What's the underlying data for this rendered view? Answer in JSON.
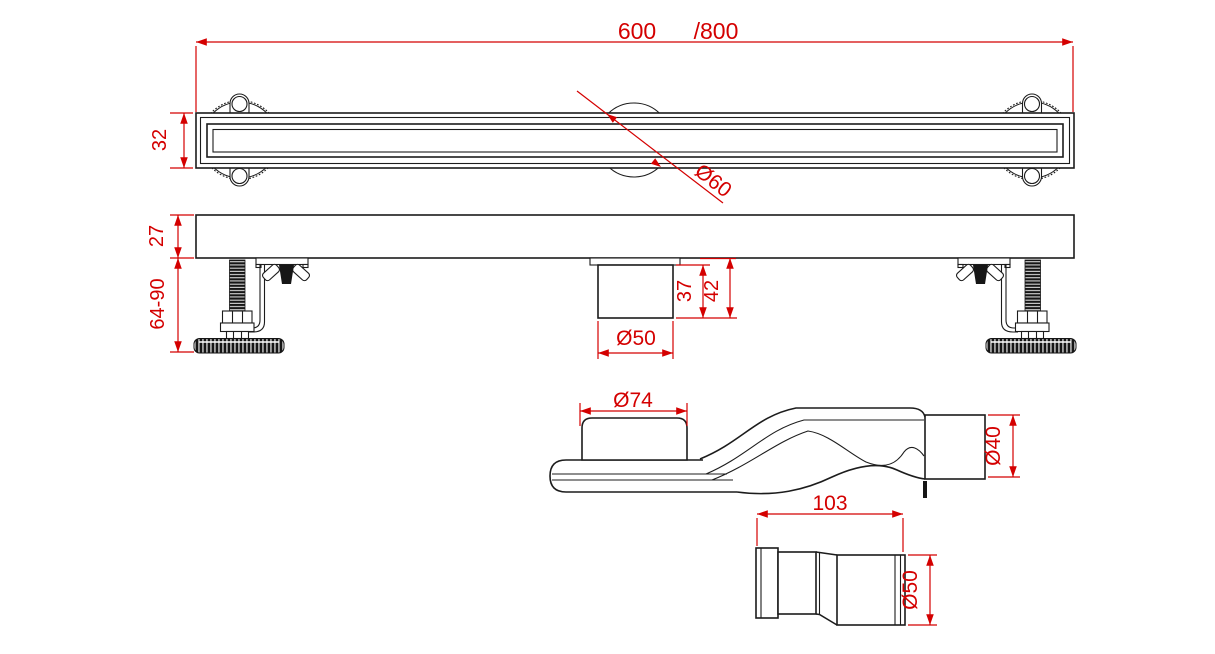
{
  "colors": {
    "dimension": "#d40000",
    "line": "#1c1c1c",
    "background": "#ffffff"
  },
  "top_view": {
    "length": "600",
    "length_alt": "/800",
    "height": "32",
    "center_flange_dia": "Ø60"
  },
  "side_view": {
    "body_height": "27",
    "feet_adjust_range": "64-90",
    "spigot_height": "37",
    "spigot_total_height": "42",
    "spigot_dia": "Ø50"
  },
  "trap": {
    "inlet_dia": "Ø74",
    "outlet_dia": "Ø40"
  },
  "adapter": {
    "length": "103",
    "dia": "Ø50"
  }
}
